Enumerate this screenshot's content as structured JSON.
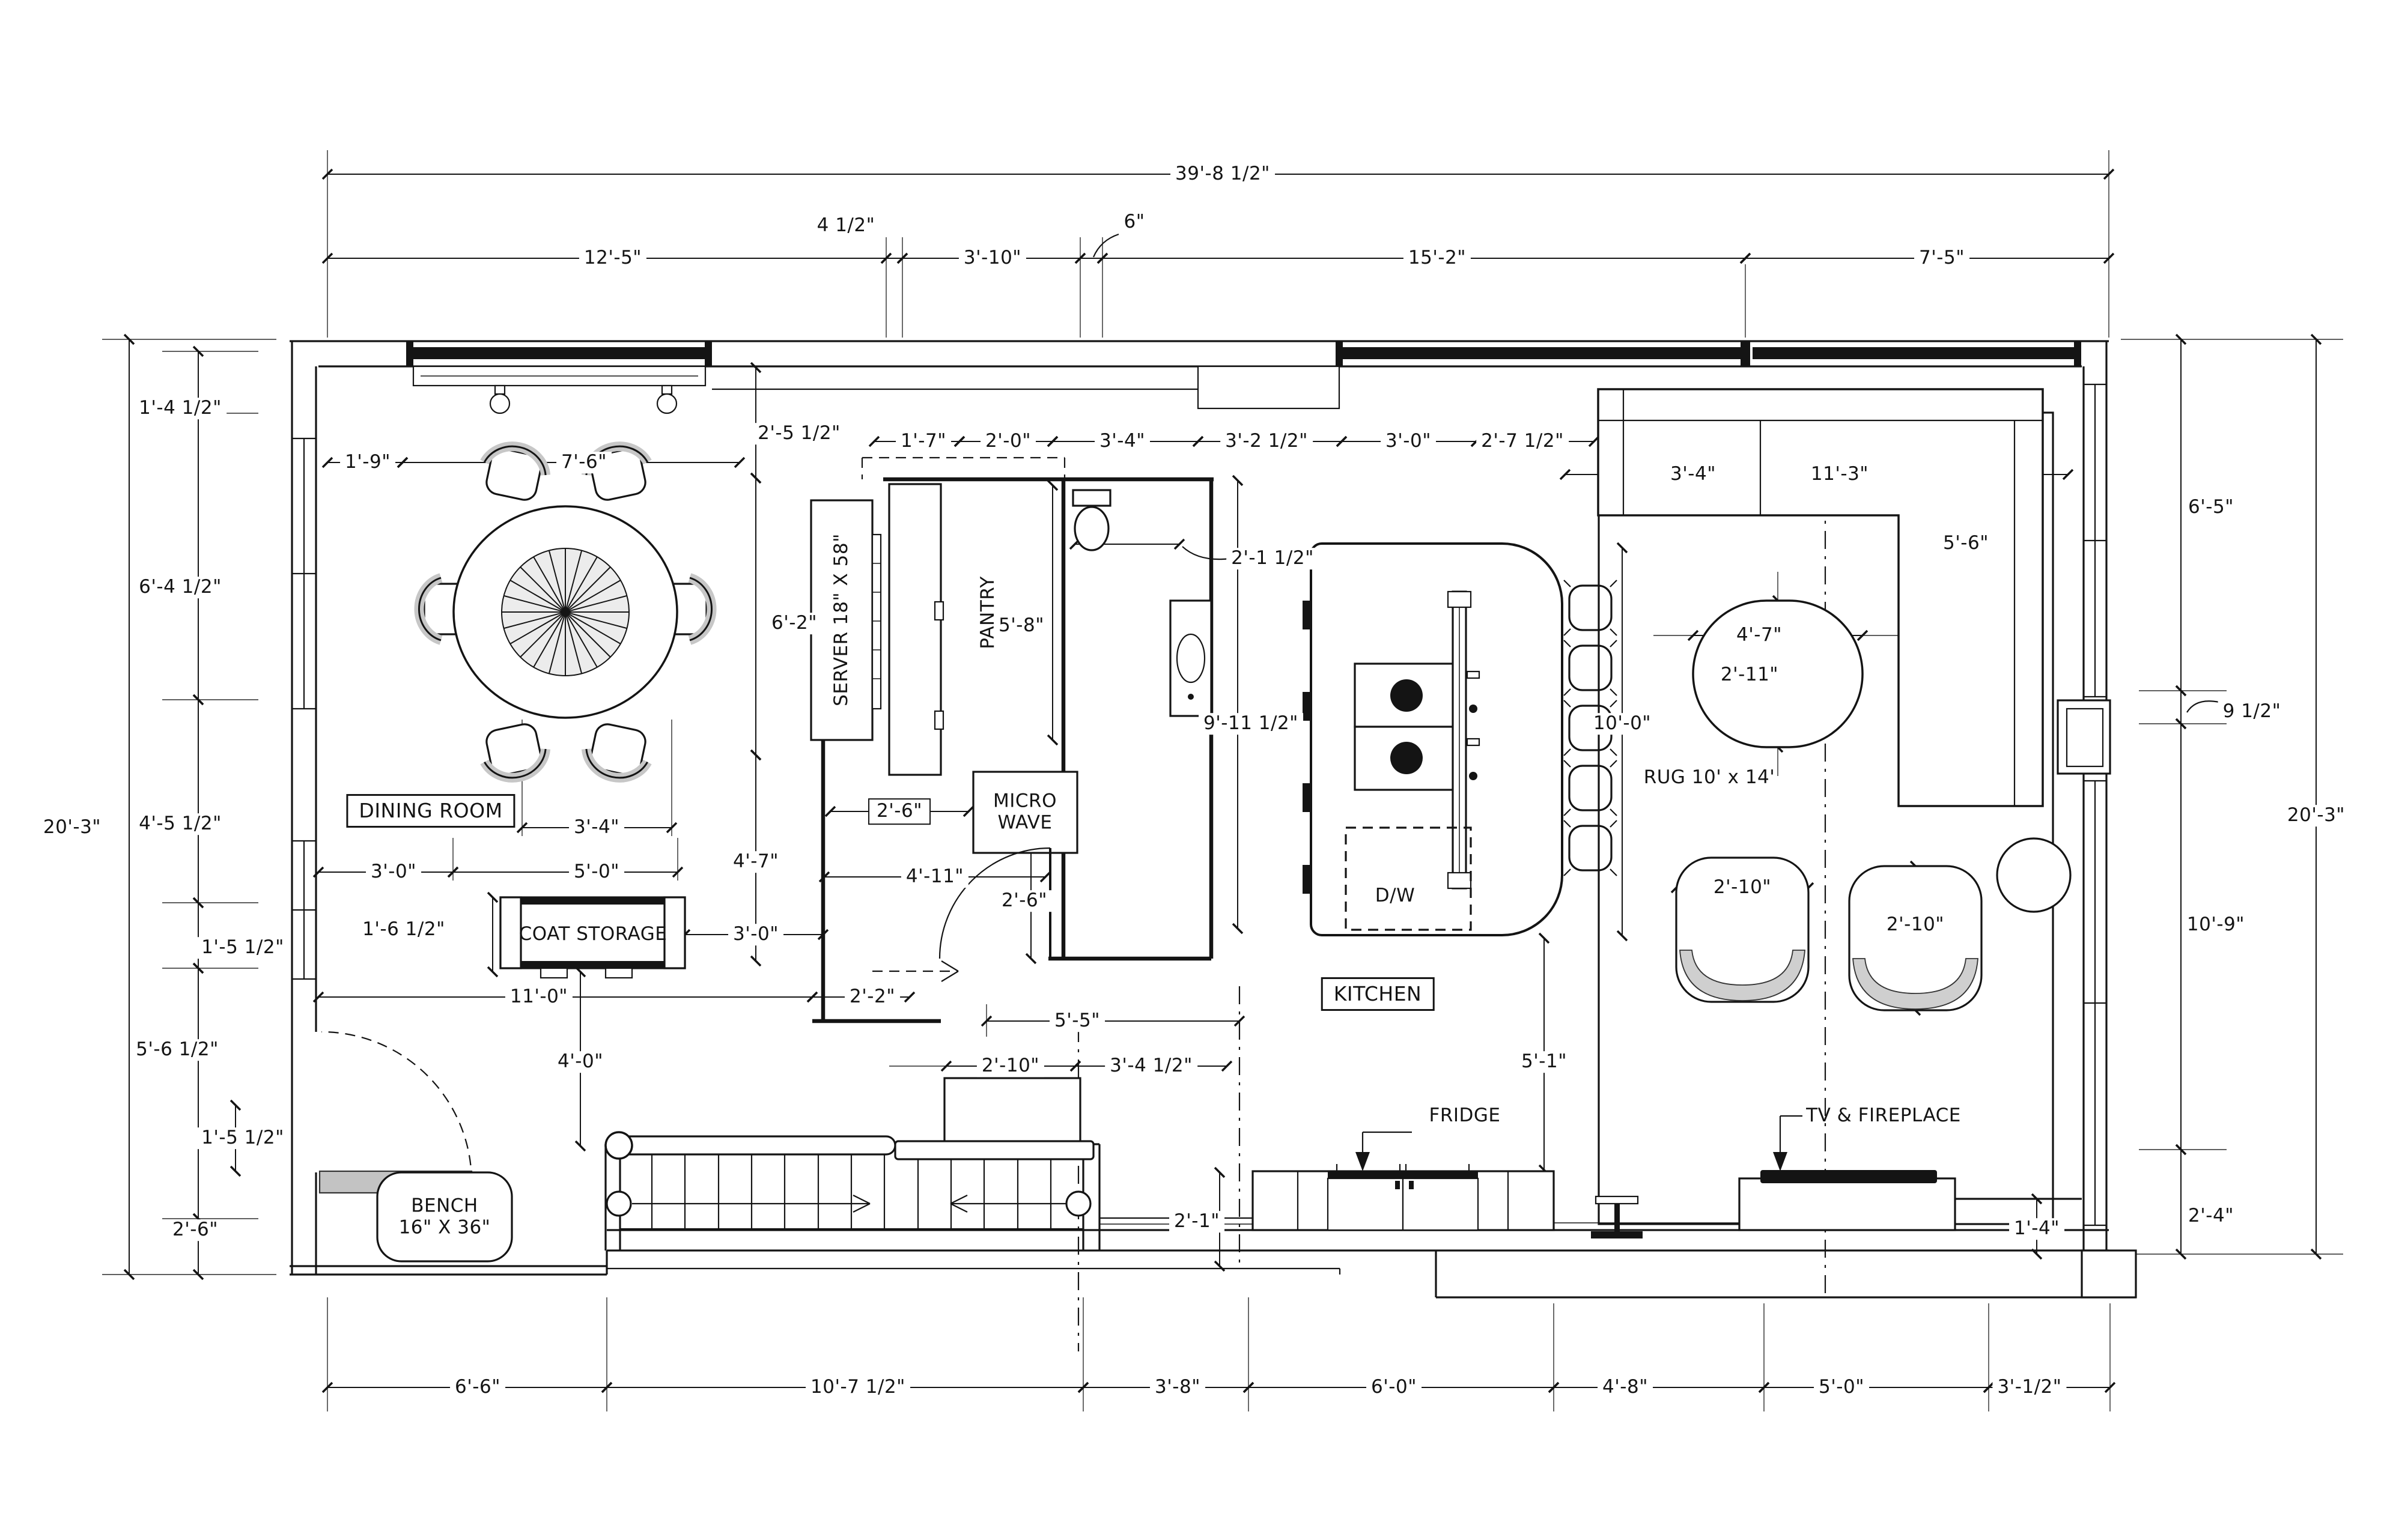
{
  "dims_top": [
    "39'-8 1/2\"",
    "12'-5\"",
    "4 1/2\"",
    "3'-10\"",
    "6\"",
    "15'-2\"",
    "7'-5\""
  ],
  "dims_left": [
    "1'-4 1/2\"",
    "6'-4 1/2\"",
    "20'-3\"",
    "4'-5 1/2\"",
    "1'-5 1/2\"",
    "5'-6 1/2\"",
    "1'-5 1/2\"",
    "2'-6\""
  ],
  "dims_right": [
    "6'-5\"",
    "9 1/2\"",
    "20'-3\"",
    "10'-9\"",
    "2'-4\""
  ],
  "dims_bottom": [
    "6'-6\"",
    "10'-7 1/2\"",
    "3'-8\"",
    "6'-0\"",
    "4'-8\"",
    "5'-0\"",
    "3'-1/2\""
  ],
  "dims_interior": [
    "1'-9\"",
    "7'-6\"",
    "2'-5 1/2\"",
    "1'-7\"",
    "2'-0\"",
    "3'-4\"",
    "3'-2 1/2\"",
    "3'-0\"",
    "2'-7 1/2\"",
    "3'-4\"",
    "11'-3\"",
    "5'-6\"",
    "6'-2\"",
    "5'-8\"",
    "2'-1 1/2\"",
    "9'-11 1/2\"",
    "10'-0\"",
    "4'-7\"",
    "2'-11\"",
    "3'-4\"",
    "2'-6\"",
    "3'-0\"",
    "5'-0\"",
    "4'-7\"",
    "4'-11\"",
    "2'-6\"",
    "3'-0\"",
    "1'-6 1/2\"",
    "11'-0\"",
    "2'-2\"",
    "2'-10\"",
    "2'-10\"",
    "4'-0\"",
    "2'-10\"",
    "3'-4 1/2\"",
    "5'-5\"",
    "5'-1\"",
    "2'-1\"",
    "1'-4\""
  ],
  "labels": {
    "dining_room": "DINING ROOM",
    "kitchen": "KITCHEN",
    "coat_storage": "COAT STORAGE",
    "server": "SERVER 18\" X 58\"",
    "pantry": "PANTRY",
    "microwave": "MICRO\nWAVE",
    "dishwasher": "D/W",
    "rug": "RUG 10' x 14'",
    "fridge": "FRIDGE",
    "tv_fireplace": "TV & FIREPLACE",
    "bench": "BENCH\n16\" X 36\""
  }
}
